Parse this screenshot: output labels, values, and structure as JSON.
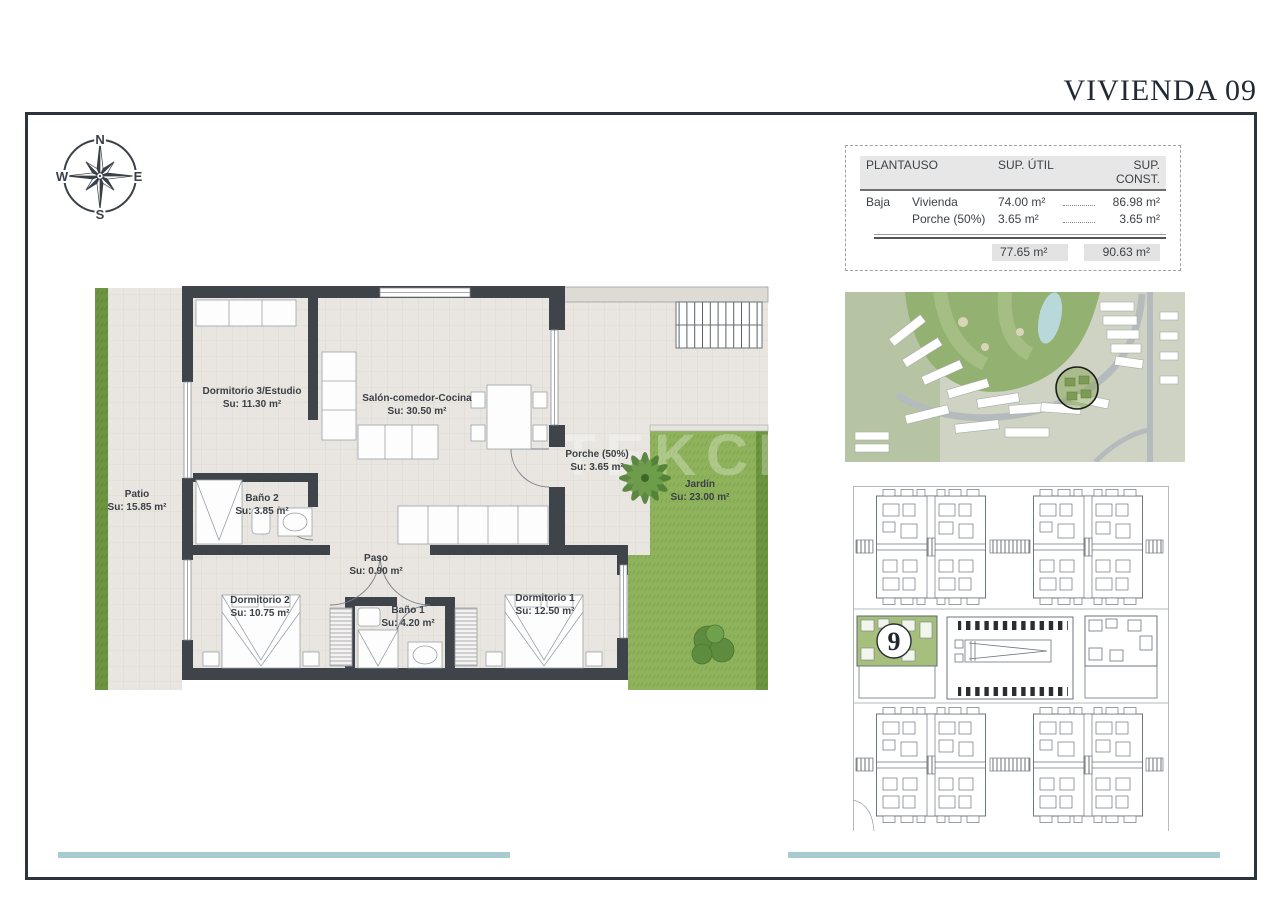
{
  "page": {
    "title": "VIVIENDA 09"
  },
  "compass": {
    "n": "N",
    "e": "E",
    "s": "S",
    "w": "W"
  },
  "summary_table": {
    "col_planta": "PLANTA",
    "col_uso": "USO",
    "col_util": "SUP. ÚTIL",
    "col_const": "SUP. CONST.",
    "rows": [
      {
        "planta": "Baja",
        "uso": "Vivienda",
        "util": "74.00 m²",
        "const": "86.98 m²"
      },
      {
        "planta": "",
        "uso": "Porche (50%)",
        "util": "3.65 m²",
        "const": "3.65 m²"
      }
    ],
    "total_util": "77.65 m²",
    "total_const": "90.63 m²"
  },
  "floorplan": {
    "watermark": "TEKCE",
    "rooms": [
      {
        "name": "Patio",
        "area": "Su: 15.85 m²"
      },
      {
        "name": "Dormitorio 3/Estudio",
        "area": "Su: 11.30 m²"
      },
      {
        "name": "Salón-comedor-Cocina",
        "area": "Su: 30.50 m²"
      },
      {
        "name": "Baño 2",
        "area": "Su: 3.85 m²"
      },
      {
        "name": "Porche (50%)",
        "area": "Su: 3.65 m²"
      },
      {
        "name": "Jardín",
        "area": "Su: 23.00 m²"
      },
      {
        "name": "Paso",
        "area": "Su: 0.90 m²"
      },
      {
        "name": "Dormitorio 2",
        "area": "Su: 10.75 m²"
      },
      {
        "name": "Baño 1",
        "area": "Su: 4.20 m²"
      },
      {
        "name": "Dormitorio 1",
        "area": "Su: 12.50 m²"
      }
    ]
  },
  "site_plan": {
    "unit_number": "9"
  },
  "colors": {
    "frame": "#2d333b",
    "walls": "#3f444b",
    "grass": "#8fb35c",
    "tile": "#e9e6e1",
    "teal_accent": "#a7cbce",
    "unit_highlight": "#a6bf7d"
  }
}
